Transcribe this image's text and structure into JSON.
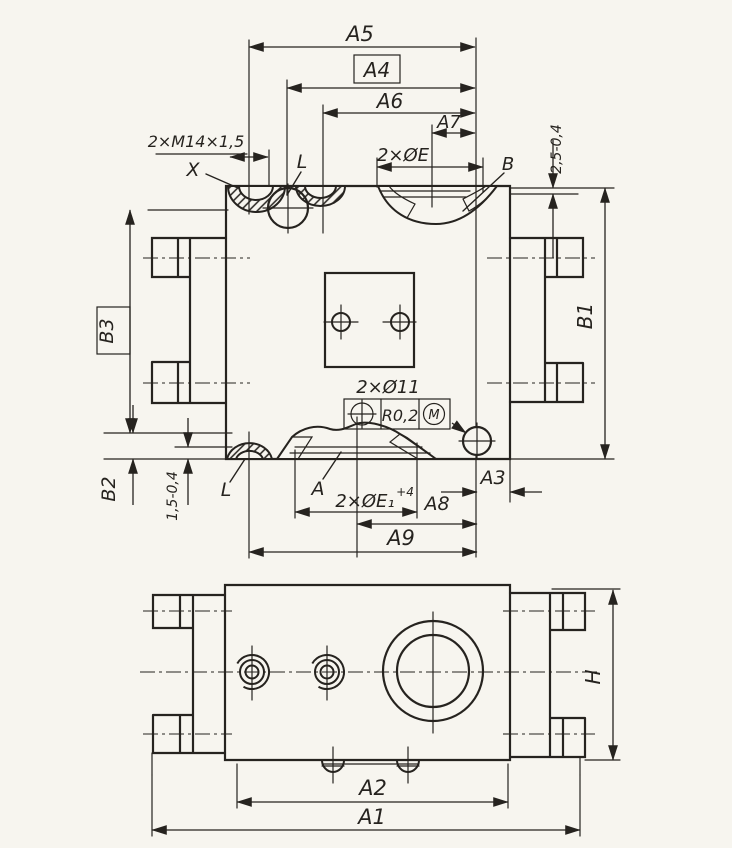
{
  "drawing": {
    "ink_color": "#26231f",
    "paper_color": "#f7f5ef",
    "top_view": {
      "dim_a5": "A5",
      "dim_a4": "A4",
      "dim_a6": "A6",
      "dim_a7": "A7",
      "dim_a8": "A8",
      "dim_a9": "A9",
      "dim_a3": "A3",
      "dim_b1": "B1",
      "dim_b2": "B2",
      "dim_b3": "B3",
      "depth_top": "2,5-0,4",
      "depth_bottom": "1,5-0,4",
      "thread_note": "2×M14×1,5",
      "holes_e_note": "2×ØE",
      "holes_e1_note": "2×ØE₁",
      "holes_e1_tol": "+4",
      "holes_11_note": "2×Ø11",
      "ref_x": "X",
      "ref_l_top": "L",
      "ref_l_bottom": "L",
      "ref_a": "A",
      "ref_b": "B",
      "tolerance_frame": {
        "value": "R0,2",
        "modifier": "M"
      }
    },
    "bottom_view": {
      "dim_a1": "A1",
      "dim_a2": "A2",
      "dim_h": "H"
    }
  }
}
